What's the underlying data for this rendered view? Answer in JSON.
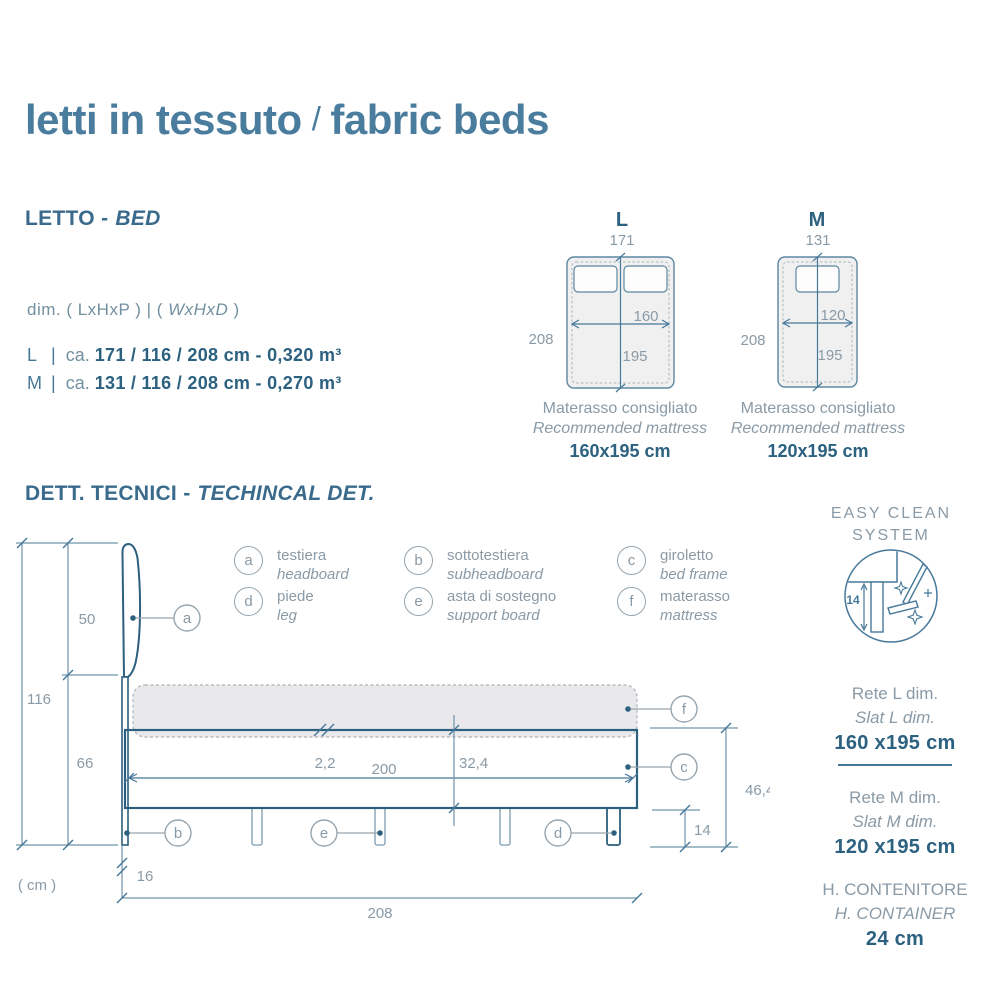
{
  "page": {
    "title_it": "letti in tessuto",
    "title_sep": "/",
    "title_en": "fabric beds"
  },
  "letto": {
    "heading_it": "LETTO -",
    "heading_en": "BED",
    "dim_prefix": "dim. ( LxHxP ) | (",
    "dim_italic": "WxHxD",
    "dim_suffix": ")",
    "rows": [
      {
        "code": "L",
        "bar": "|",
        "approx": "ca.",
        "value": "171 / 116 / 208 cm - 0,320 m³"
      },
      {
        "code": "M",
        "bar": "|",
        "approx": "ca.",
        "value": "131 / 116 / 208 cm - 0,270 m³"
      }
    ]
  },
  "beds": [
    {
      "label": "L",
      "top": "171",
      "side": "208",
      "inner_w": "160",
      "inner_h": "195",
      "caption_it": "Materasso consigliato",
      "caption_en": "Recommended mattress",
      "caption_value": "160x195 cm"
    },
    {
      "label": "M",
      "top": "131",
      "side": "208",
      "inner_w": "120",
      "inner_h": "195",
      "caption_it": "Materasso consigliato",
      "caption_en": "Recommended mattress",
      "caption_value": "120x195 cm"
    }
  ],
  "tecnici": {
    "heading_it": "DETT. TECNICI -",
    "heading_en": "TECHINCAL DET."
  },
  "legend": [
    {
      "key": "a",
      "it": "testiera",
      "en": "headboard"
    },
    {
      "key": "b",
      "it": "sottotestiera",
      "en": "subheadboard"
    },
    {
      "key": "c",
      "it": "giroletto",
      "en": "bed frame"
    },
    {
      "key": "d",
      "it": "piede",
      "en": "leg"
    },
    {
      "key": "e",
      "it": "asta di sostegno",
      "en": "support board"
    },
    {
      "key": "f",
      "it": "materasso",
      "en": "mattress"
    }
  ],
  "drawing": {
    "unit": "( cm )",
    "d116": "116",
    "d50": "50",
    "d66": "66",
    "d16": "16",
    "d208": "208",
    "d200": "200",
    "d22": "2,2",
    "d324": "32,4",
    "d464": "46,4",
    "d14": "14",
    "callouts": {
      "a": "a",
      "b": "b",
      "c": "c",
      "d": "d",
      "e": "e",
      "f": "f"
    }
  },
  "easy_clean": {
    "line1": "EASY CLEAN",
    "line2": "SYSTEM",
    "dim": "14"
  },
  "right_panel": {
    "slat_l": {
      "it": "Rete L dim.",
      "en": "Slat L dim.",
      "value": "160 x195 cm"
    },
    "slat_m": {
      "it": "Rete M dim.",
      "en": "Slat M dim.",
      "value": "120 x195 cm"
    },
    "container": {
      "it": "H. CONTENITORE",
      "en": "H. CONTAINER",
      "value": "24 cm"
    }
  },
  "colors": {
    "accent": "#46789a",
    "dark": "#2d5f7e",
    "line": "#7c9cb0",
    "muted": "#8a9aa6",
    "value": "#2c6180"
  }
}
